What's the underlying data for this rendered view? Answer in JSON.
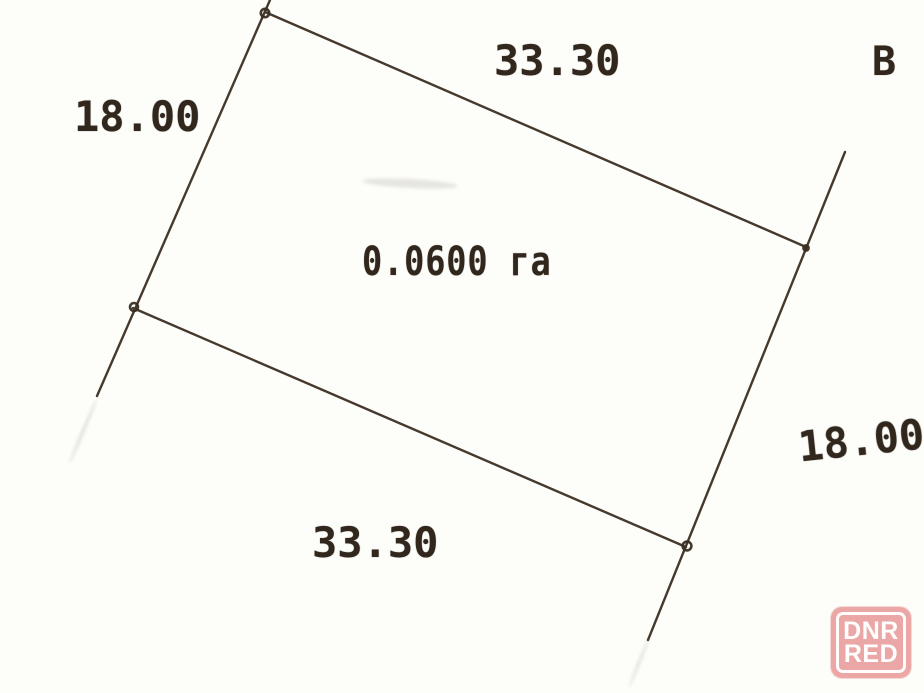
{
  "plot": {
    "area": "0.0600 га",
    "top_length": "33.30",
    "bottom_length": "33.30",
    "left_length": "18.00",
    "right_length": "18.00",
    "corner_letter": "В"
  },
  "watermark": {
    "line1": "DNR",
    "line2": "RED"
  },
  "colors": {
    "ink": "#3b2f23",
    "paper": "#fdfdfa",
    "watermark_bg": "#e79494",
    "watermark_text": "#ffffff"
  }
}
